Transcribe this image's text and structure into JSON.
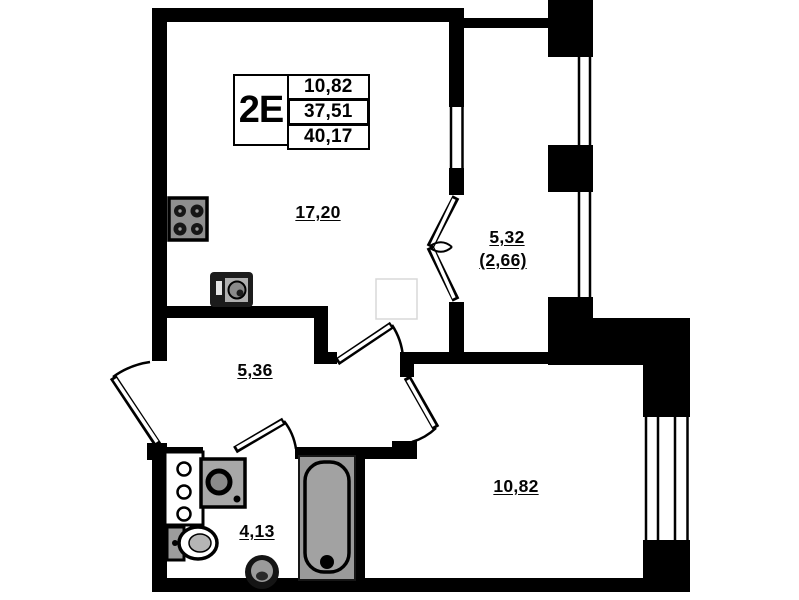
{
  "legend": {
    "type_label": "2E",
    "rows": [
      {
        "value": "10,82"
      },
      {
        "value": "37,51"
      },
      {
        "value": "40,17"
      }
    ]
  },
  "rooms": {
    "living_room": {
      "area": "17,20"
    },
    "balcony": {
      "area": "5,32",
      "area_with_coefficient": "(2,66)"
    },
    "hallway": {
      "area": "5,36"
    },
    "bathroom": {
      "area": "4,13"
    },
    "bedroom": {
      "area": "10,82"
    }
  }
}
